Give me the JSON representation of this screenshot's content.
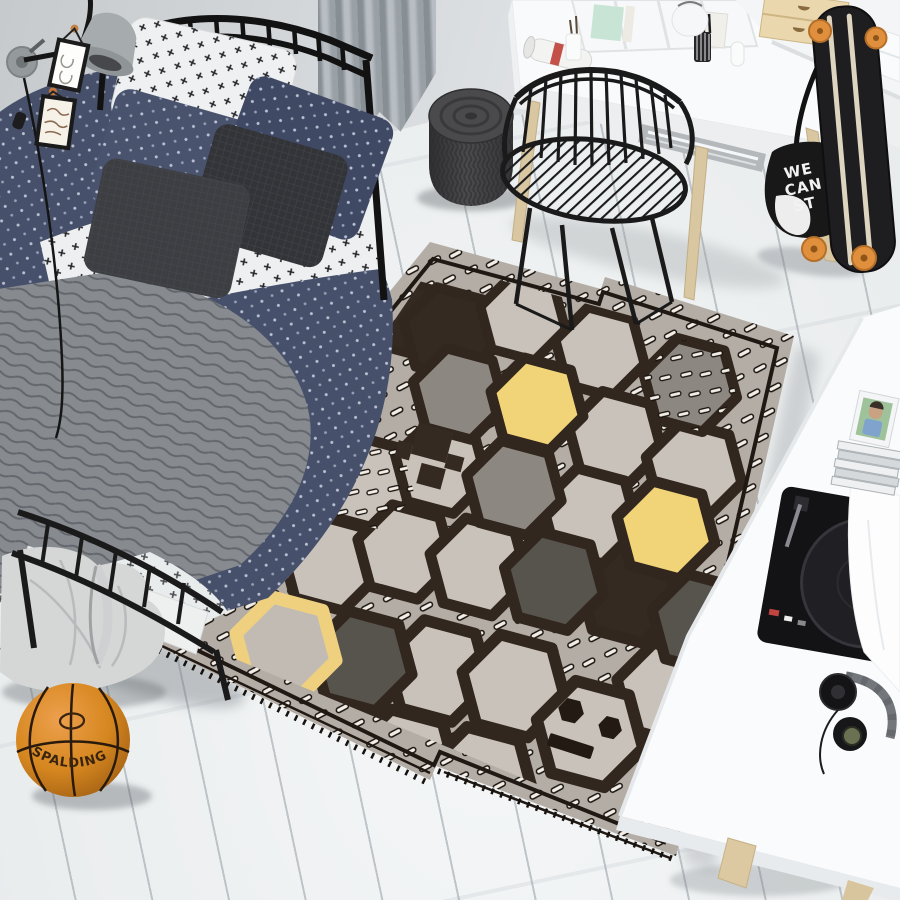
{
  "scene": {
    "label": "teen bedroom with honeycomb play rug"
  },
  "colors": {
    "floor": "#eef0f1",
    "wall": "#d3d7d9",
    "rug_field": "#b4ada6",
    "rug_outline": "#32271e",
    "rug_border": "#1f1813",
    "rug_hex_light": "#c9c2ba",
    "rug_hex_gray": "#8d8781",
    "rug_hex_dark": "#57534d",
    "rug_hex_brown": "#352a21",
    "rug_yellow": "#f2d478",
    "grain_fill": "#f2eee7",
    "duvet_navy": "#47506a",
    "quilt_gray": "#878b90",
    "frame_black": "#141414",
    "wood_light": "#d9c7a2",
    "wheel_orange": "#e08f3d",
    "basketball_orange": "#d3821f",
    "bag_black": "#181818",
    "pouf_charcoal": "#3f3f42"
  },
  "basketball": {
    "brand": "SPALDING"
  },
  "tote_bag": {
    "line1": "WE",
    "line2": "CAN",
    "line3": "ST"
  },
  "rug": {
    "motifs": [
      "honeycomb-hexagon",
      "rice-grain-dash",
      "pixel-creeper",
      "smiley-face"
    ],
    "yellow_solid_hexes": 2,
    "yellow_outline_hexes": 1
  }
}
